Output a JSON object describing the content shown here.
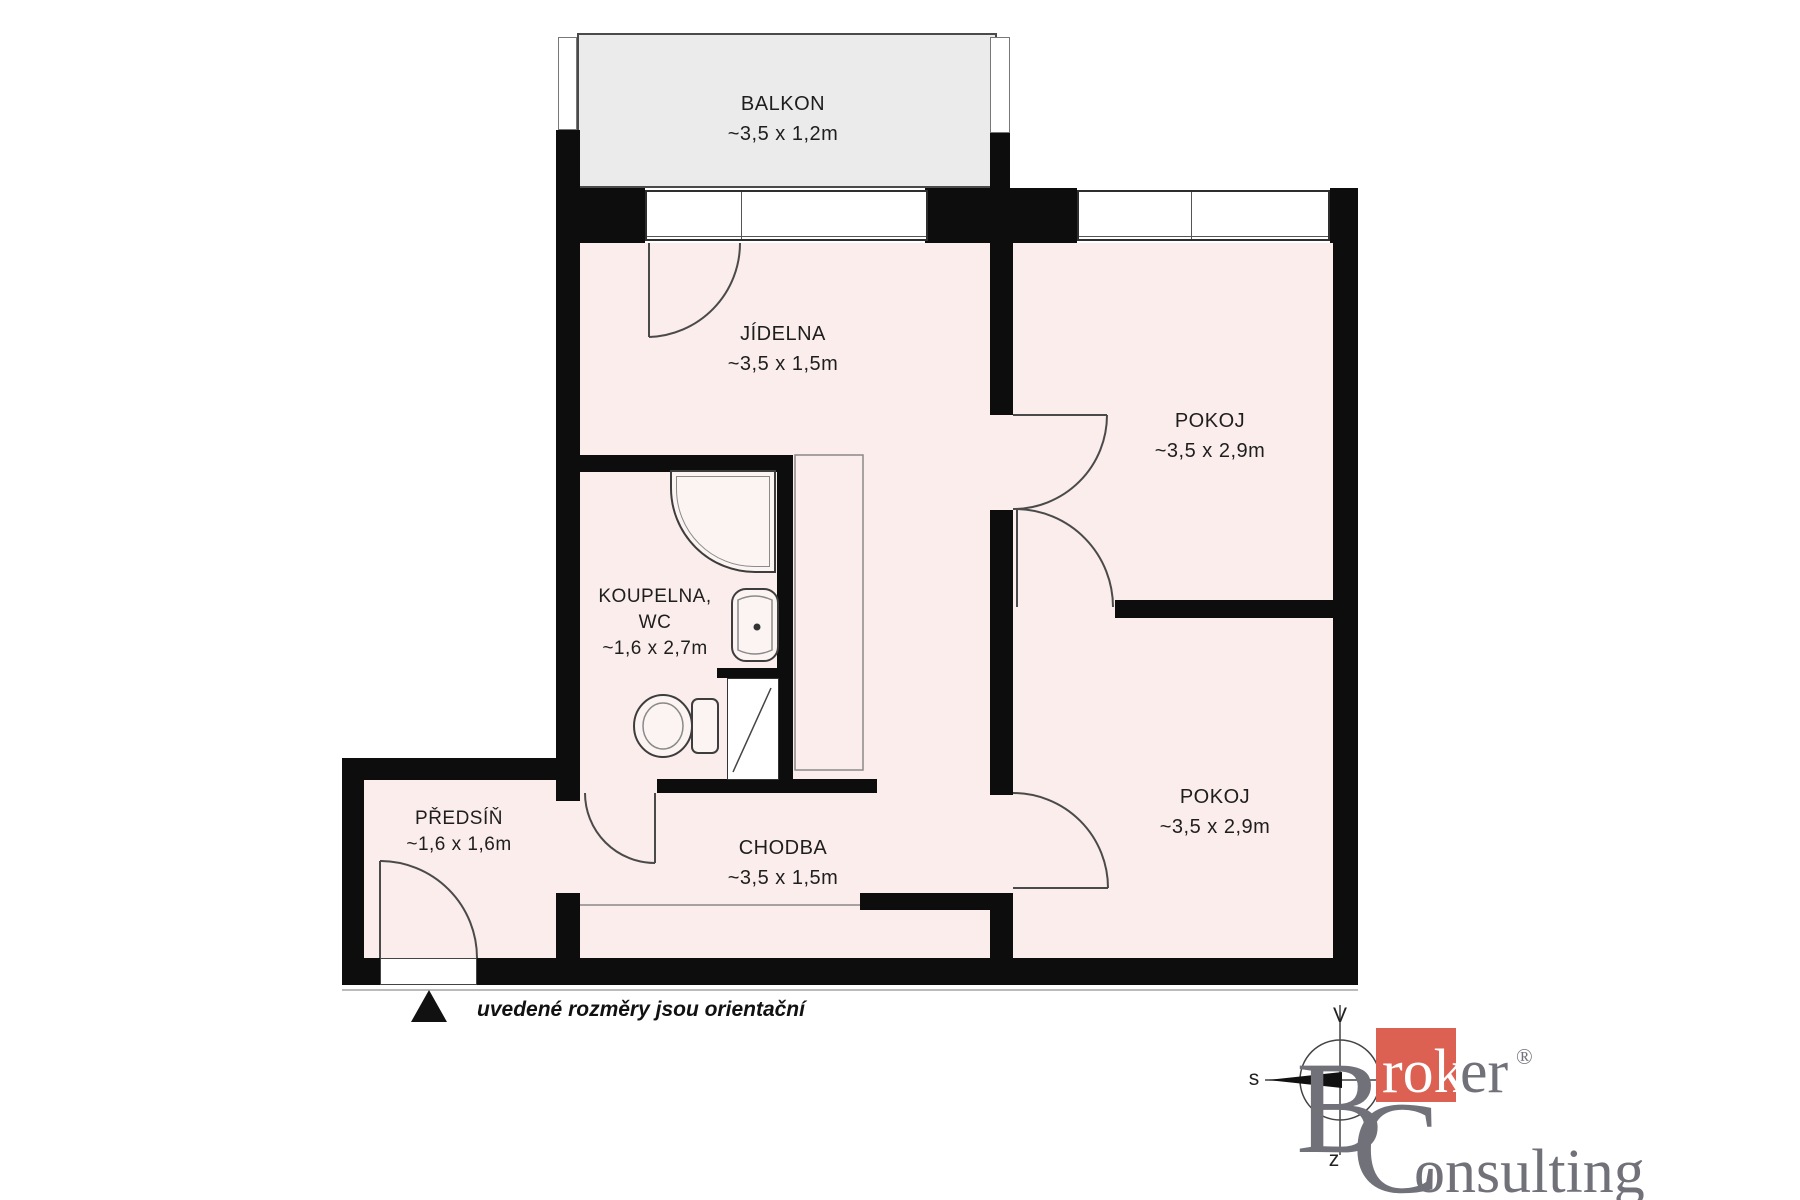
{
  "note": "uvedené rozměry jsou orientační",
  "rooms": [
    {
      "id": "balkon",
      "name": "BALKON",
      "dims": "~3,5 x 1,2m"
    },
    {
      "id": "jidelna",
      "name": "JÍDELNA",
      "dims": "~3,5 x 1,5m"
    },
    {
      "id": "pokoj1",
      "name": "POKOJ",
      "dims": "~3,5 x 2,9m"
    },
    {
      "id": "koupelna",
      "name": "KOUPELNA,",
      "name2": "WC",
      "dims": "~1,6 x 2,7m"
    },
    {
      "id": "predsin",
      "name": "PŘEDSÍŇ",
      "dims": "~1,6 x 1,6m"
    },
    {
      "id": "chodba",
      "name": "CHODBA",
      "dims": "~3,5 x 1,5m"
    },
    {
      "id": "pokoj2",
      "name": "POKOJ",
      "dims": "~3,5 x 2,9m"
    }
  ],
  "compass": {
    "top": "V",
    "left": "s",
    "bottom": "z"
  },
  "logo": {
    "initial_b": "B",
    "rok": "rok",
    "er": "er",
    "reg": "®",
    "initial_c": "C",
    "onsulting": "onsulting"
  },
  "colors": {
    "wall": "#0d0d0d",
    "floor": "#faedeb",
    "balcony": "#ebebeb",
    "accent_orange": "#dc6152",
    "logo_gray": "#71717a"
  }
}
